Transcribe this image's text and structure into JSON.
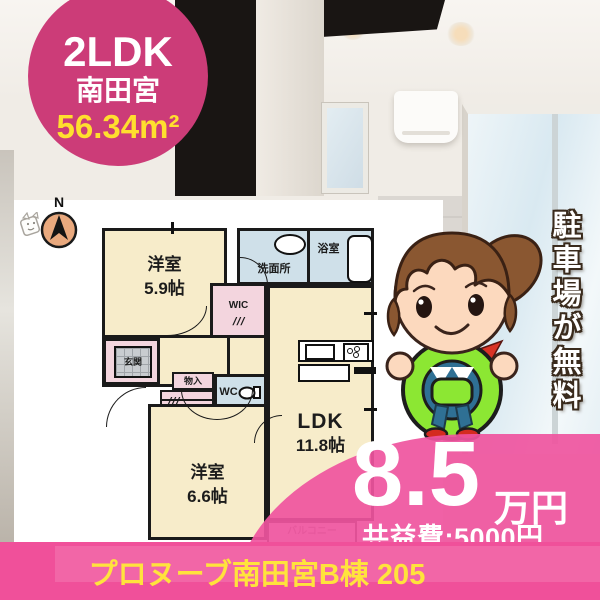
{
  "badge": {
    "layout": "2LDK",
    "name": "南田宮",
    "area": "56.34m²"
  },
  "compass": {
    "label": "N"
  },
  "floorplan": {
    "bedroom1": {
      "name": "洋室",
      "size": "5.9帖"
    },
    "washroom": {
      "label": "洗面所"
    },
    "bathroom": {
      "label": "浴室"
    },
    "wic": {
      "label": "WIC"
    },
    "genkan": {
      "label": "玄関"
    },
    "storage": {
      "label": "物入"
    },
    "wc": {
      "label": "WC"
    },
    "bedroom2": {
      "name": "洋室",
      "size": "6.6帖"
    },
    "ldk": {
      "name": "LDK",
      "size": "11.8帖"
    },
    "balcony": {
      "label": "バルコニー"
    },
    "closet_mark": "///"
  },
  "banner": {
    "parking": "駐車場が無料"
  },
  "price": {
    "amount": "8.5",
    "unit": "万円",
    "common_fee": "共益費:5000円"
  },
  "footer": {
    "title": "プロヌーブ南田宮B棟 205"
  },
  "colors": {
    "accent_pink": "#ef549e",
    "badge_pink": "#cc3c78",
    "highlight_yellow": "#ffe33c",
    "room_cream": "#f7ecca",
    "wet_area_blue": "#cfe0e9",
    "closet_pink": "#f3d5de",
    "wheel_green": "#8ce733"
  }
}
